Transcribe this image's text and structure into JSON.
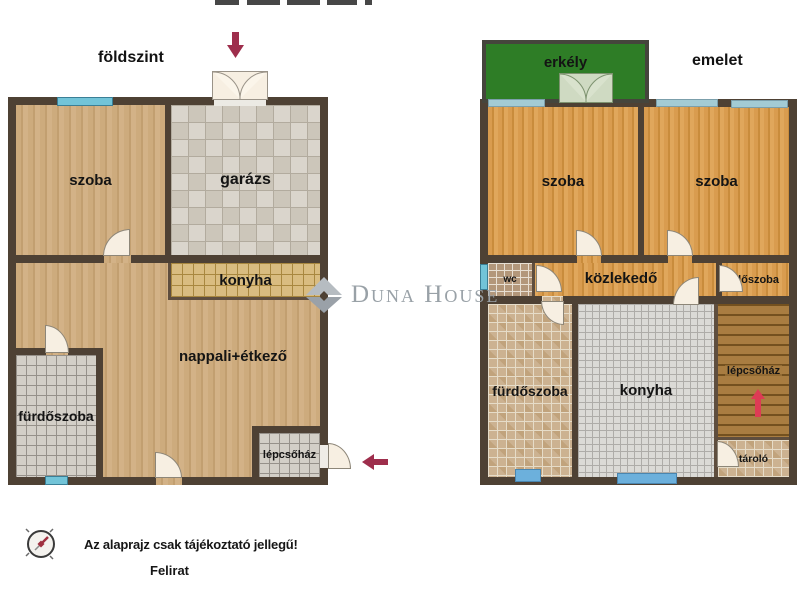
{
  "floors": {
    "ground": {
      "title": "földszint",
      "rooms": {
        "szoba": "szoba",
        "garazs": "garázs",
        "konyha": "konyha",
        "nappali": "nappali+étkező",
        "furdoszoba": "fürdőszoba",
        "lepcsohaz": "lépcsőház"
      }
    },
    "upper": {
      "title": "emelet",
      "rooms": {
        "erkely": "erkély",
        "szoba_left": "szoba",
        "szoba_right": "szoba",
        "wc": "wc",
        "kozlekedo": "közlekedő",
        "eloszoba": "előszoba",
        "furdoszoba": "fürdőszoba",
        "konyha": "konyha",
        "lepcsohaz": "lépcsőház",
        "tarolo": "tároló"
      }
    }
  },
  "watermark": {
    "text": "Duna House"
  },
  "footer": {
    "disclaimer": "Az alaprajz csak tájékoztató jellegű!",
    "caption": "Felirat"
  },
  "colors": {
    "wall": "#4e4134",
    "balcony_green": "#2e7d26",
    "window_cyan": "#72c4d8",
    "entrance_arrow": "#9e2e4c",
    "stairs_arrow": "#dd3b55",
    "watermark_grey": "#99a1a7"
  }
}
